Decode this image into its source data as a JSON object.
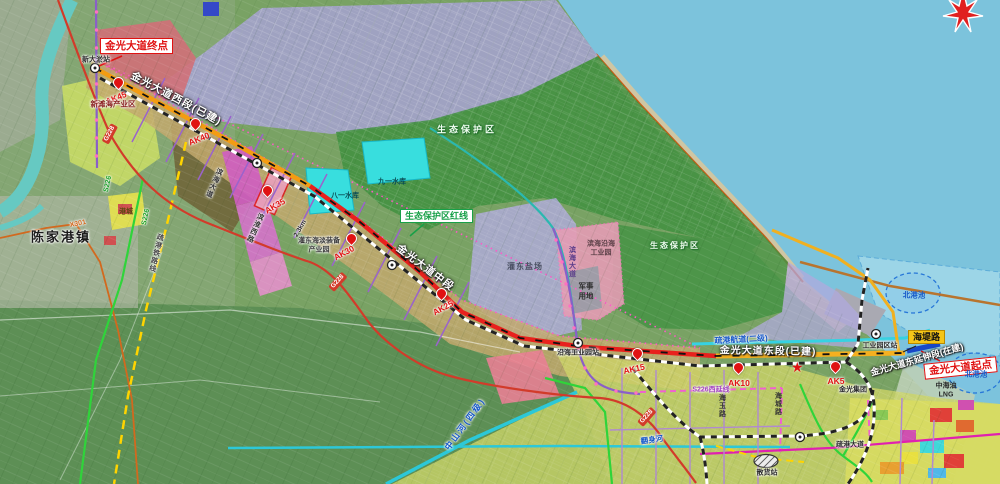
{
  "map": {
    "callouts": {
      "endpoint": "金光大道终点",
      "startpoint": "金光大道起点",
      "eco_redline": "生态保护区红线",
      "haidi_road": "海堤路"
    },
    "road_segments": {
      "west": "金光大道西段(已建)",
      "middle": "金光大道中段",
      "east": "金光大道东段(已建)",
      "extension": "金光大道东延伸段(在建)"
    },
    "ak_points": [
      {
        "label": "AK45"
      },
      {
        "label": "AK40"
      },
      {
        "label": "AK35"
      },
      {
        "label": "AK30"
      },
      {
        "label": "AK25"
      },
      {
        "label": "AK15"
      },
      {
        "label": "AK10"
      },
      {
        "label": "AK5"
      }
    ],
    "zones": {
      "eco_area": "生态保护区",
      "xintan_industry": "新滩海产业区",
      "gangcheng": "港城",
      "guandong_salt": "灌东盐场",
      "binhai_coastal_park_line1": "滨海沿海",
      "binhai_coastal_park_line2": "工业园",
      "military_line1": "军事",
      "military_line2": "用地",
      "guandong_equip_line1": "灌东海淡装备",
      "guandong_equip_line2": "产业园",
      "jinguang_group": "金光集团",
      "lng_line1": "中海油",
      "lng_line2": "LNG",
      "north_basin": "北港池"
    },
    "water": {
      "bayi_reservoir": "八一水库",
      "jiuyi_reservoir": "九一水库",
      "zhongshan_river": "中山河(四级)",
      "fanshen_river": "翻身河",
      "port_channel": "疏港航道(二级)"
    },
    "towns": {
      "chenjiagang": "陈家港镇"
    },
    "stations": {
      "xindayu": "新大淤站",
      "yanhai_park": "沿海工业园站",
      "industry_park": "工业园区站",
      "bulk_cargo": "散货站"
    },
    "roads": {
      "g228": "G228",
      "s226": "S226",
      "x301": "X301",
      "s226_west_ext": "S226西延线",
      "shugang_avenue": "疏港大道",
      "shugang_railway": "疏港铁路线",
      "binhai_avenue": "滨海大道",
      "binhuai_west_road": "滨淮西路",
      "haicheng_road": "海城路",
      "haiyu_road": "海玉路"
    },
    "annotations": {
      "seg_km": "2.3km"
    },
    "colors": {
      "road_built": "#f39c12",
      "road_planned": "#e8211d",
      "road_extension": "#1848c8",
      "eco_green": "#3f8c3f",
      "sea": "#7cc3dc",
      "reservoir": "#35dede"
    }
  }
}
